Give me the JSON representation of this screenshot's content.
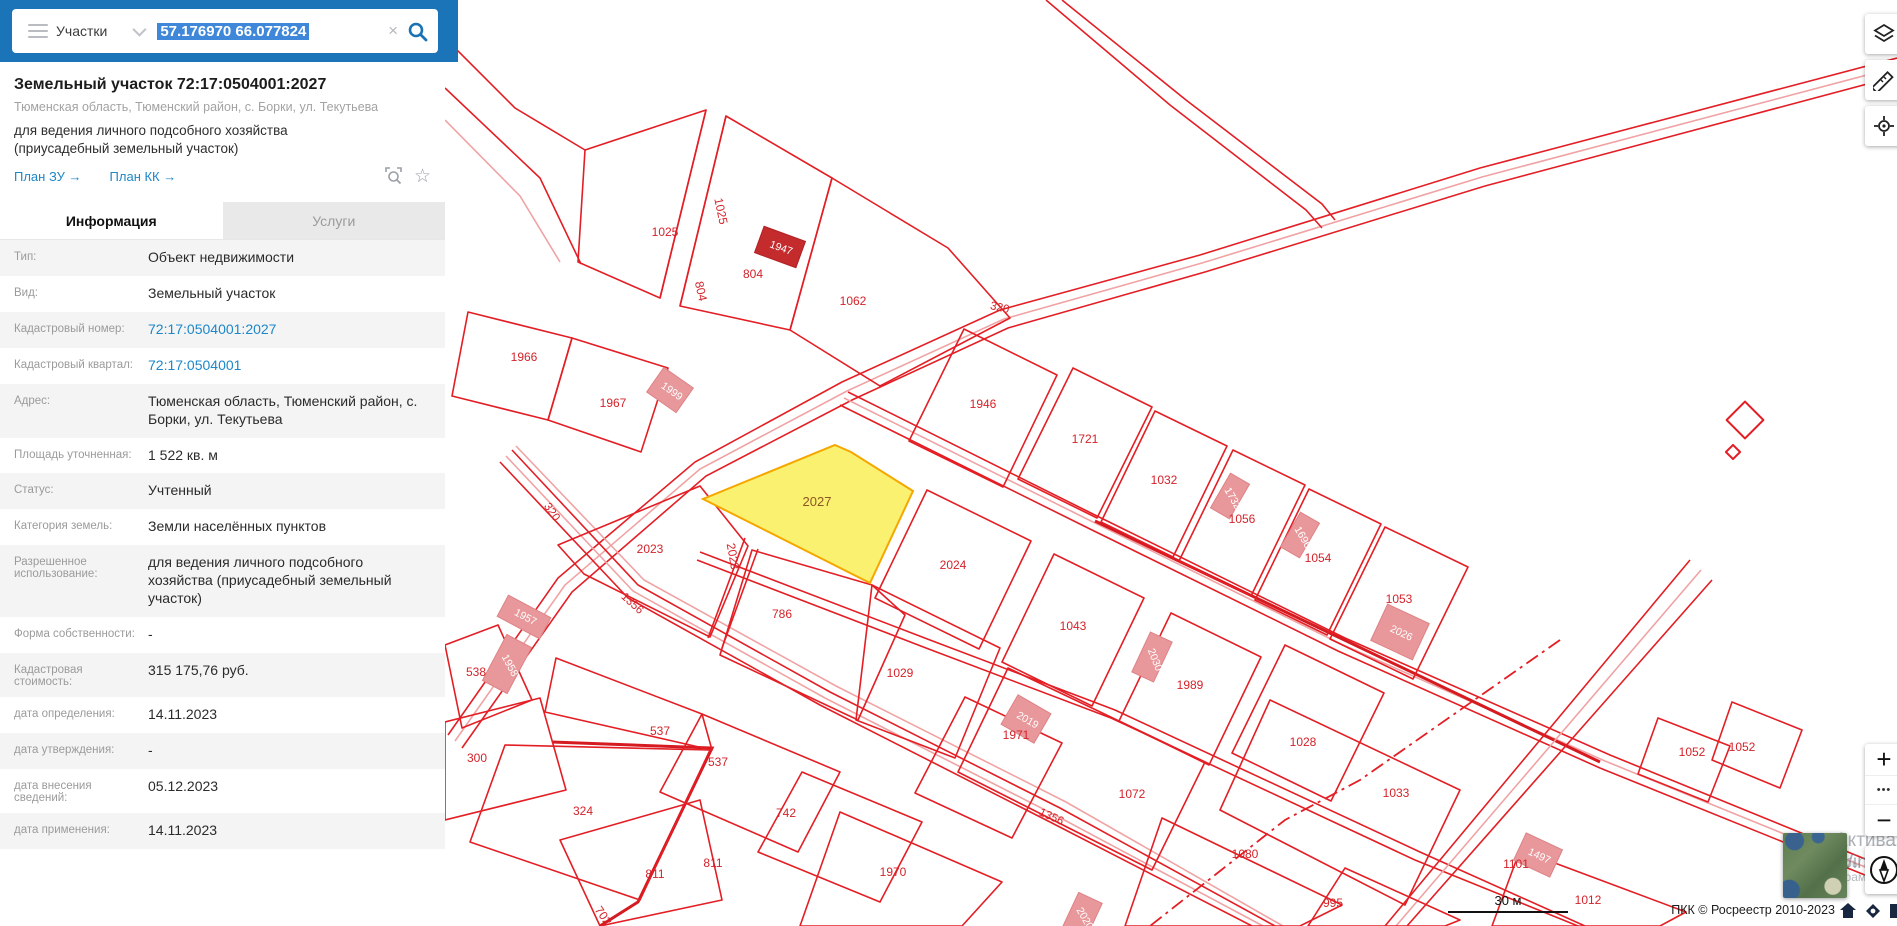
{
  "colors": {
    "accent_blue": "#1b74b8",
    "selection_blue": "#3f87d9",
    "link_blue": "#1d87c8",
    "map_red": "#e31e24",
    "selected_parcel_fill": "#fbf170",
    "selected_parcel_stroke": "#f5a700"
  },
  "search": {
    "category": "Участки",
    "query": "57.176970 66.077824",
    "clear_glyph": "×",
    "collapse_glyph": "‹"
  },
  "panel": {
    "title": "Земельный участок 72:17:0504001:2027",
    "address": "Тюменская область, Тюменский район, с. Борки, ул. Текутьева",
    "usage": "для ведения личного подсобного хозяйства (приусадебный земельный участок)",
    "links": [
      {
        "label": "План ЗУ →"
      },
      {
        "label": "План КК →"
      }
    ],
    "tabs": [
      {
        "label": "Информация",
        "active": true
      },
      {
        "label": "Услуги",
        "active": false
      }
    ],
    "info_rows": [
      {
        "label": "Тип:",
        "value": "Объект недвижимости"
      },
      {
        "label": "Вид:",
        "value": "Земельный участок"
      },
      {
        "label": "Кадастровый номер:",
        "value": "72:17:0504001:2027",
        "link": true
      },
      {
        "label": "Кадастровый квартал:",
        "value": "72:17:0504001",
        "link": true
      },
      {
        "label": "Адрес:",
        "value": "Тюменская область, Тюменский район, с. Борки, ул. Текутьева"
      },
      {
        "label": "Площадь уточненная:",
        "value": "1 522 кв. м"
      },
      {
        "label": "Статус:",
        "value": "Учтенный"
      },
      {
        "label": "Категория земель:",
        "value": "Земли населённых пунктов"
      },
      {
        "label": "Разрешенное использование:",
        "value": "для ведения личного подсобного хозяйства (приусадебный земельный участок)"
      },
      {
        "label": "Форма собственности:",
        "value": "-"
      },
      {
        "label": "Кадастровая стоимость:",
        "value": "315 175,76 руб."
      },
      {
        "label": "дата определения:",
        "value": "14.11.2023"
      },
      {
        "label": "дата утверждения:",
        "value": "-"
      },
      {
        "label": "дата внесения сведений:",
        "value": "05.12.2023"
      },
      {
        "label": "дата применения:",
        "value": "14.11.2023"
      }
    ]
  },
  "map": {
    "controls": {
      "zoom_in": "+",
      "more": "•••",
      "zoom_out": "−"
    },
    "scale_label": "30 м",
    "attribution": "ПКК © Росреестр 2010-2023",
    "watermark": {
      "line1": "Активация Windows",
      "line2": "Чтобы активировать Windows, перейдите в раздел \"Параметры\".",
      "fragment_small": "м в ",
      "fragment_big": "Р"
    },
    "labels": [
      {
        "t": "1966",
        "x": 524,
        "y": 361,
        "r": 0,
        "k": "p"
      },
      {
        "t": "1967",
        "x": 613,
        "y": 407,
        "r": 0,
        "k": "p"
      },
      {
        "t": "1025",
        "x": 665,
        "y": 236,
        "r": 0,
        "k": "p"
      },
      {
        "t": "1025",
        "x": 717,
        "y": 212,
        "r": 78,
        "k": "p"
      },
      {
        "t": "804",
        "x": 697,
        "y": 292,
        "r": 78,
        "k": "p"
      },
      {
        "t": "804",
        "x": 753,
        "y": 278,
        "r": 0,
        "k": "p"
      },
      {
        "t": "1062",
        "x": 853,
        "y": 305,
        "r": 0,
        "k": "p"
      },
      {
        "t": "320",
        "x": 999,
        "y": 311,
        "r": 13,
        "k": "r"
      },
      {
        "t": "320",
        "x": 549,
        "y": 514,
        "r": 55,
        "k": "r"
      },
      {
        "t": "1946",
        "x": 983,
        "y": 408,
        "r": 0,
        "k": "p"
      },
      {
        "t": "1721",
        "x": 1085,
        "y": 443,
        "r": 0,
        "k": "p"
      },
      {
        "t": "1032",
        "x": 1164,
        "y": 484,
        "r": 0,
        "k": "p"
      },
      {
        "t": "1056",
        "x": 1242,
        "y": 523,
        "r": 0,
        "k": "p"
      },
      {
        "t": "1054",
        "x": 1318,
        "y": 562,
        "r": 0,
        "k": "p"
      },
      {
        "t": "1053",
        "x": 1399,
        "y": 603,
        "r": 0,
        "k": "p"
      },
      {
        "t": "2023",
        "x": 650,
        "y": 553,
        "r": 0,
        "k": "p"
      },
      {
        "t": "2023",
        "x": 729,
        "y": 557,
        "r": 80,
        "k": "p"
      },
      {
        "t": "2027",
        "x": 817,
        "y": 506,
        "r": 0,
        "k": "s"
      },
      {
        "t": "2024",
        "x": 953,
        "y": 569,
        "r": 0,
        "k": "p"
      },
      {
        "t": "1043",
        "x": 1073,
        "y": 630,
        "r": 0,
        "k": "p"
      },
      {
        "t": "1989",
        "x": 1190,
        "y": 689,
        "r": 0,
        "k": "p"
      },
      {
        "t": "1028",
        "x": 1303,
        "y": 746,
        "r": 0,
        "k": "p"
      },
      {
        "t": "786",
        "x": 782,
        "y": 618,
        "r": 0,
        "k": "p"
      },
      {
        "t": "1029",
        "x": 900,
        "y": 677,
        "r": 0,
        "k": "p"
      },
      {
        "t": "1971",
        "x": 1016,
        "y": 739,
        "r": 0,
        "k": "p"
      },
      {
        "t": "1072",
        "x": 1132,
        "y": 798,
        "r": 0,
        "k": "p"
      },
      {
        "t": "1033",
        "x": 1396,
        "y": 797,
        "r": 0,
        "k": "p"
      },
      {
        "t": "1080",
        "x": 1245,
        "y": 858,
        "r": 0,
        "k": "p"
      },
      {
        "t": "995",
        "x": 1333,
        "y": 907,
        "r": 0,
        "k": "p"
      },
      {
        "t": "1012",
        "x": 1588,
        "y": 904,
        "r": 0,
        "k": "p"
      },
      {
        "t": "1970",
        "x": 893,
        "y": 876,
        "r": 0,
        "k": "p"
      },
      {
        "t": "742",
        "x": 786,
        "y": 817,
        "r": 0,
        "k": "p"
      },
      {
        "t": "537",
        "x": 660,
        "y": 735,
        "r": 0,
        "k": "p"
      },
      {
        "t": "537",
        "x": 718,
        "y": 766,
        "r": 0,
        "k": "p"
      },
      {
        "t": "811",
        "x": 655,
        "y": 878,
        "r": 0,
        "k": "p"
      },
      {
        "t": "811",
        "x": 713,
        "y": 867,
        "r": 0,
        "k": "p"
      },
      {
        "t": "300",
        "x": 477,
        "y": 762,
        "r": 0,
        "k": "p"
      },
      {
        "t": "324",
        "x": 583,
        "y": 815,
        "r": 0,
        "k": "p"
      },
      {
        "t": "538",
        "x": 476,
        "y": 676,
        "r": 0,
        "k": "p"
      },
      {
        "t": "1101",
        "x": 1516,
        "y": 868,
        "r": 0,
        "k": "p"
      },
      {
        "t": "1052",
        "x": 1692,
        "y": 756,
        "r": 0,
        "k": "p"
      },
      {
        "t": "1052",
        "x": 1742,
        "y": 751,
        "r": 0,
        "k": "p"
      },
      {
        "t": "1356",
        "x": 630,
        "y": 606,
        "r": 42,
        "k": "r"
      },
      {
        "t": "1356",
        "x": 1050,
        "y": 820,
        "r": 24,
        "k": "r"
      },
      {
        "t": "702",
        "x": 600,
        "y": 918,
        "r": 55,
        "k": "p"
      },
      {
        "t": "1947",
        "x": 780,
        "y": 251,
        "r": 20,
        "k": "b"
      },
      {
        "t": "1999",
        "x": 670,
        "y": 394,
        "r": 35,
        "k": "b"
      },
      {
        "t": "1957",
        "x": 524,
        "y": 620,
        "r": 28,
        "k": "b"
      },
      {
        "t": "1958",
        "x": 507,
        "y": 667,
        "r": 62,
        "k": "b"
      },
      {
        "t": "2019",
        "x": 1026,
        "y": 723,
        "r": 30,
        "k": "b"
      },
      {
        "t": "2030",
        "x": 1152,
        "y": 661,
        "r": 68,
        "k": "b"
      },
      {
        "t": "1732",
        "x": 1230,
        "y": 500,
        "r": 60,
        "k": "b"
      },
      {
        "t": "1696",
        "x": 1300,
        "y": 539,
        "r": 60,
        "k": "b"
      },
      {
        "t": "2026",
        "x": 1400,
        "y": 636,
        "r": 25,
        "k": "b"
      },
      {
        "t": "1497",
        "x": 1538,
        "y": 859,
        "r": 25,
        "k": "b"
      },
      {
        "t": "2020",
        "x": 1082,
        "y": 920,
        "r": 60,
        "k": "b"
      }
    ]
  }
}
